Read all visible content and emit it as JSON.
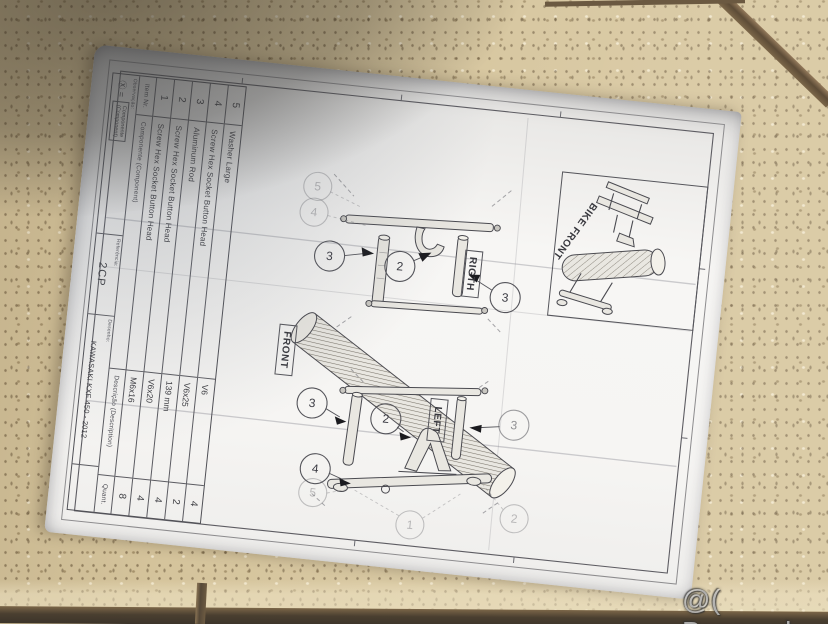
{
  "scene": {
    "watermark": "@( Bazos.sk"
  },
  "sheet": {
    "labels": {
      "bike_front": "BIKE FRONT",
      "right_view": "RIGTH",
      "front_view": "FRONT",
      "left_view": "LEFT"
    },
    "balloons": {
      "right_view": [
        "3",
        "2",
        "3",
        "5",
        "4"
      ],
      "left_view": [
        "3",
        "2",
        "3",
        "4",
        "5",
        "1",
        "2"
      ]
    },
    "parts_table": {
      "headers": {
        "item": "Item Nr.",
        "component": "Componente (Component)",
        "description": "Descrição (Description)",
        "quantity": "Quant."
      },
      "rows": [
        {
          "item": "5",
          "component": "Washer Large",
          "description": "V6",
          "quantity": "4"
        },
        {
          "item": "4",
          "component": "Screw Hex Socket Button Head",
          "description": "V6x25",
          "quantity": "2"
        },
        {
          "item": "3",
          "component": "Aluminum Rod",
          "description": "139 mm",
          "quantity": "4"
        },
        {
          "item": "2",
          "component": "Screw Hex Socket Button Head",
          "description": "V6x20",
          "quantity": "4"
        },
        {
          "item": "1",
          "component": "Screw Hex Socket Button Head",
          "description": "M6x16",
          "quantity": "8"
        }
      ]
    },
    "title_block": {
      "observation_label": "Observação:",
      "observation_symbol": "Ⓧ =",
      "observation_line1": "Componente",
      "observation_line2": "(Component)",
      "reference_label": "Referência:",
      "reference_value": "2CP",
      "drawing_label": "Desenho:",
      "drawing_value": "KAWASAKI KXF 450 - 2012"
    }
  },
  "colors": {
    "tile": "#d5c49c",
    "grout_dark": "#4a3f30",
    "paper": "#f6f5f3",
    "ink": "#3d3d42",
    "watermark": "#ffffff"
  }
}
